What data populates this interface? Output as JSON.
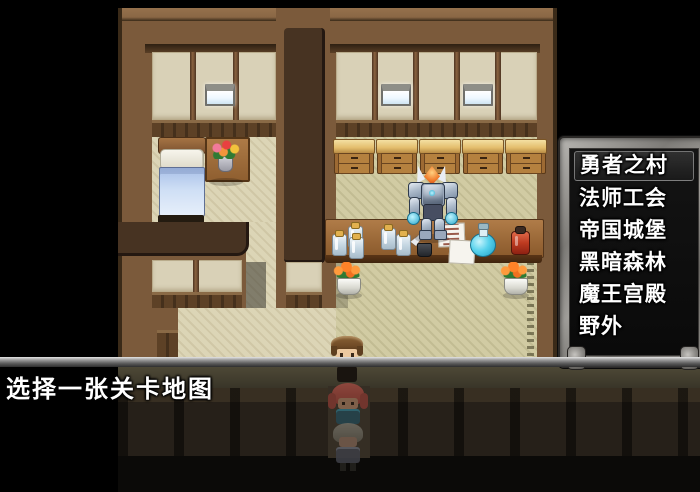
{
  "menu": {
    "title_hint": "map-select-list",
    "items": [
      {
        "label": "勇者之村",
        "selected": true
      },
      {
        "label": "法师工会",
        "selected": false
      },
      {
        "label": "帝国城堡",
        "selected": false
      },
      {
        "label": "黑暗森林",
        "selected": false
      },
      {
        "label": "魔王宫殿",
        "selected": false
      },
      {
        "label": "野外",
        "selected": false
      }
    ],
    "text_color": "#ffffff",
    "window_background": "#0d0d0d",
    "frame_color": "#8f8d89",
    "selection_border": "rgba(225,225,225,0.45)"
  },
  "message": {
    "text": "选择一张关卡地图",
    "text_color": "#ffffff"
  },
  "scene": {
    "npc": "armored-demon-shopkeeper",
    "player": "brown-haired-hero",
    "followers": [
      "red-haired-follower",
      "gray-haired-follower"
    ],
    "objects": [
      "bed",
      "flower-table",
      "wall-windows",
      "cabinet-row",
      "shop-counter",
      "glass-jars",
      "quill-and-notes",
      "blue-potion",
      "red-jar",
      "flower-pot-left",
      "flower-pot-right"
    ],
    "colors": {
      "void": "#000000",
      "wall": "#7b5a3b",
      "panel": "#d9d1b7",
      "floor": "#dcd5b6",
      "tatami": "#d1cba3",
      "counter": "#9a6838"
    }
  }
}
